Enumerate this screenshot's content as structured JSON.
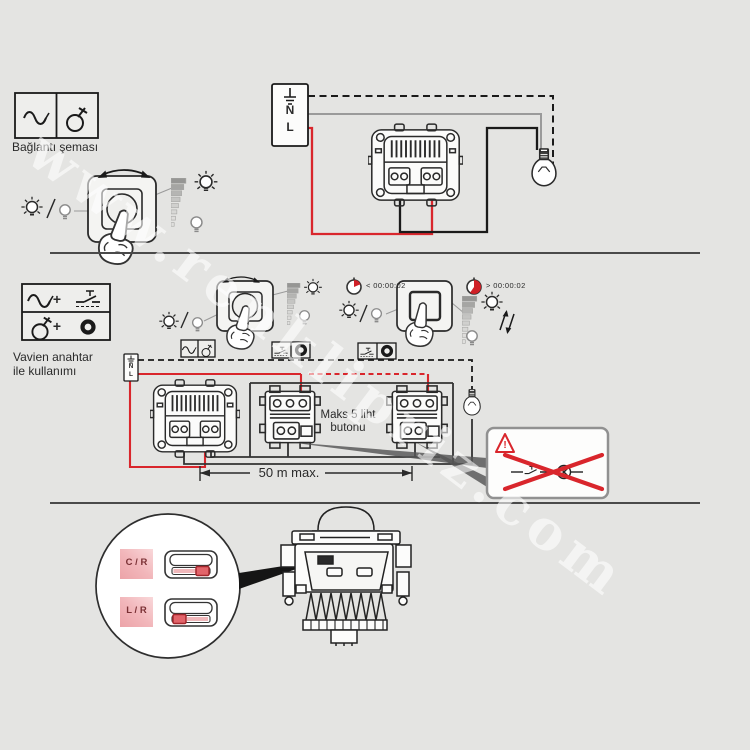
{
  "colors": {
    "background": "#e4e4e2",
    "wire_red": "#d9262c",
    "line": "#2a2a2a",
    "pink": "#f0b7ba",
    "maroon": "#7a3034"
  },
  "watermark": {
    "text": "www.renklipriz.com"
  },
  "section1": {
    "title": "Bağlantı şeması",
    "terminal_n": "N",
    "terminal_l": "L"
  },
  "section2": {
    "title_line1": "Vavien anahtar",
    "title_line2": "ile kullanımı",
    "plus1": "+",
    "plus2": "+",
    "timer_short": "< 00:00:02",
    "timer_long": "> 00:00:02",
    "terminal_n": "N",
    "terminal_l": "L",
    "max_note_line1": "Maks 5 liht",
    "max_note_line2": "butonu",
    "distance_label": "50 m max.",
    "warning_mark": "!"
  },
  "section3": {
    "selector_top": "C / R",
    "selector_bottom": "L / R"
  }
}
